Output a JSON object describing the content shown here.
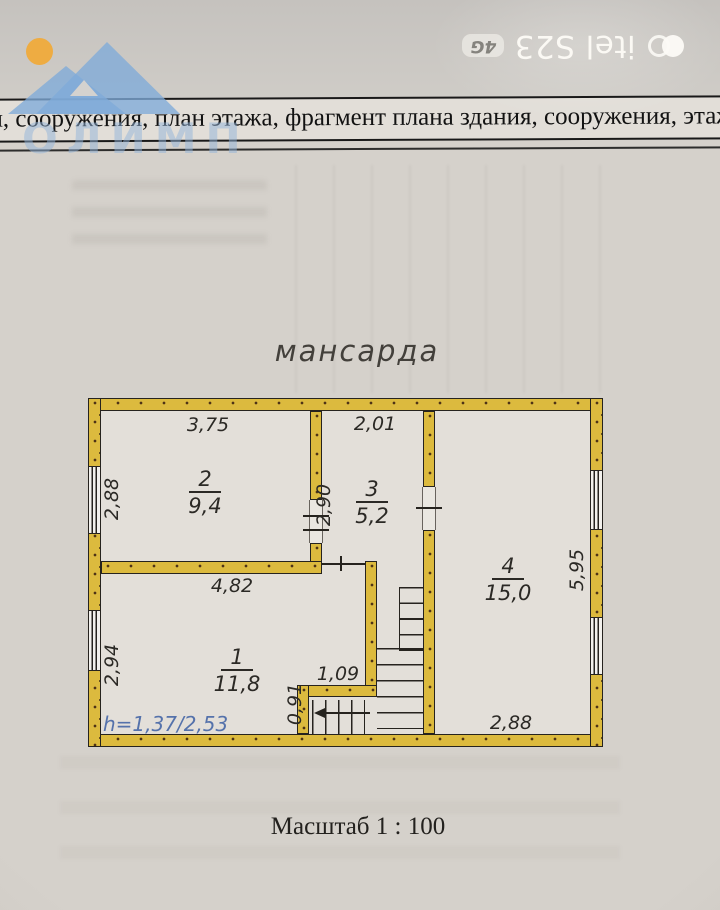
{
  "camera_watermark": {
    "device": "itel S23",
    "network_badge": "4G"
  },
  "stamp": {
    "company": "ОЛИМП"
  },
  "document_header": {
    "row_text": "ия, сооружения, план этажа, фрагмент плана здания, сооружения, этаж"
  },
  "floor_plan": {
    "title": "мансарда",
    "scale_caption": "Масштаб 1 : 100",
    "height_note": "h=1,37/2,53",
    "rooms": [
      {
        "number": "1",
        "area": "11,8"
      },
      {
        "number": "2",
        "area": "9,4"
      },
      {
        "number": "3",
        "area": "5,2"
      },
      {
        "number": "4",
        "area": "15,0"
      }
    ],
    "dimensions": {
      "room2_top": "3,75",
      "room3_top": "2,01",
      "left_upper": "2,88",
      "partition": "2,90",
      "right_side": "5,95",
      "room1_top": "4,82",
      "left_lower": "2,94",
      "stair_top": "1,09",
      "stair_side": "0,91",
      "room4_bottom": "2,88"
    },
    "colors": {
      "wall_fill": "#dcba3e",
      "height_note_text": "#5572ab",
      "mountain_blue": "#7fabd9",
      "sun_orange": "#f2a834"
    }
  }
}
